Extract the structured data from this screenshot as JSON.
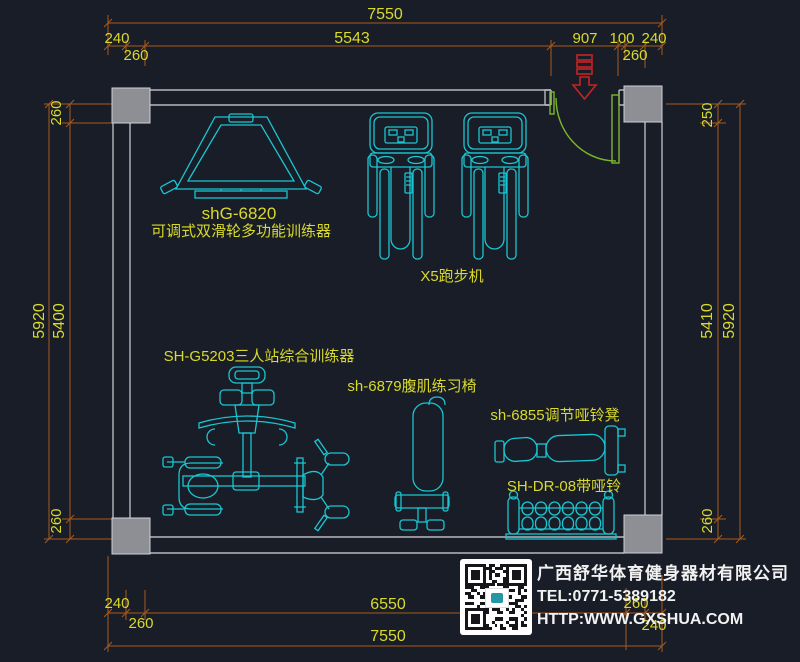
{
  "colors": {
    "background": "#181d27",
    "dimension_line": "#a85a1e",
    "dimension_text": "#d9da2b",
    "equipment_line": "#1ac6d2",
    "wall_line": "#b7b9bd",
    "column_fill": "#8d8f94",
    "door_line": "#7db62c",
    "entrance_arrow": "#c42525",
    "footer_text": "#f2f2f2"
  },
  "dims": {
    "top_total": "7550",
    "top_seg_240_left": "240",
    "top_seg_5543": "5543",
    "top_seg_907": "907",
    "top_seg_100": "100",
    "top_seg_240_right": "240",
    "top_sub_260_left": "260",
    "top_sub_260_right": "260",
    "left_260_top": "260",
    "left_5920": "5920",
    "left_5400": "5400",
    "left_260_bottom": "260",
    "right_250_top": "250",
    "right_5410": "5410",
    "right_5920": "5920",
    "right_260_bottom": "260",
    "bottom_240_left": "240",
    "bottom_260_left": "260",
    "bottom_6550": "6550",
    "bottom_260_right": "260",
    "bottom_240_right": "240",
    "bottom_total": "7550"
  },
  "labels": {
    "pulley_trainer_model": "shG-6820",
    "pulley_trainer_name": "可调式双滑轮多功能训练器",
    "treadmill": "X5跑步机",
    "multi_station": "SH-G5203三人站综合训练器",
    "ab_chair": "sh-6879腹肌练习椅",
    "dumbbell_bench": "sh-6855调节哑铃凳",
    "dumbbell_rack": "SH-DR-08带哑铃"
  },
  "footer": {
    "company": "广西舒华体育健身器材有限公司",
    "tel": "TEL:0771-5389182",
    "website": "HTTP:WWW.GXSHUA.COM"
  }
}
